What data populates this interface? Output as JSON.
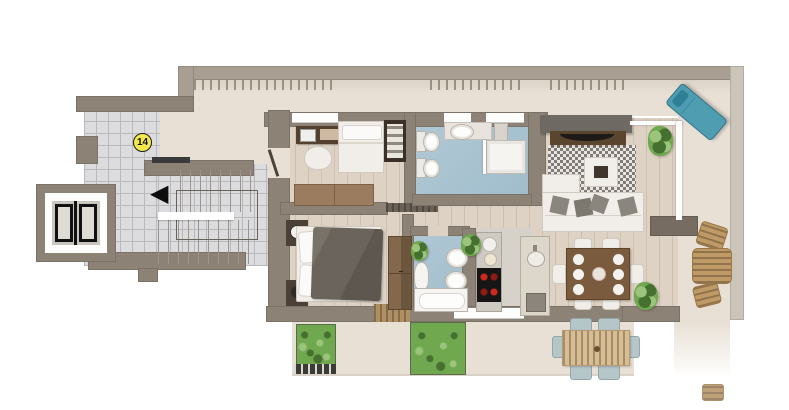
{
  "unit": {
    "number": "14"
  },
  "icons": {
    "stairs_direction_arrow": "◀",
    "elevator_doors": "css-double-door-shape"
  },
  "palette": {
    "bg": "#ffffff",
    "wall": "#8d8276",
    "parapet": "#a89e91",
    "parapetLight": "#cbc4b9",
    "woodFloor": "#ddd2c3",
    "terraceFloor": "#e8e0d5",
    "tileFloor": "#dcdcde",
    "bathFloor": "#b2c9d5",
    "kitchenFloor": "#d6d1c9",
    "furnWhite": "#f1eeea",
    "sofaTan": "#9c7c5e",
    "deskBrown": "#54402e",
    "duvetGray": "#6b645c",
    "wardrobeBrown": "#83684c",
    "tvWall": "#6e6a63",
    "consoleBrown": "#5a452f",
    "loungerTeal": "#4f9db1",
    "rattan": "#c09a66",
    "outdoorWood": "#d8bc92",
    "outdoorCushion": "#b5c6c9",
    "plantGreen": "#6fa84f",
    "cooktopBlack": "#161616",
    "burnerRed": "#cc2a1e",
    "badgeYellow": "#f3e94c",
    "arrowBlack": "#0d0d0d"
  }
}
